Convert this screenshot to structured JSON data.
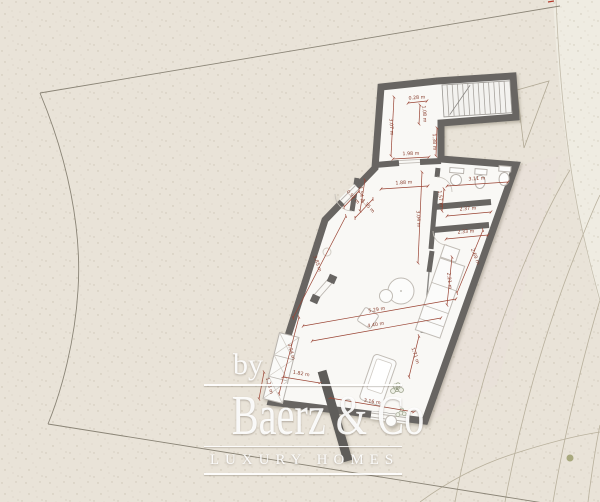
{
  "title": "Villa site / floor plan with dimensions",
  "colors": {
    "background": "#e9e3d8",
    "background_outside": "#efece2",
    "terrace_tint": "#e9dfd9",
    "wall": "#676562",
    "floor": "#f9f8f5",
    "stair_tread": "#f3f2ef",
    "dimension": "#9a4434",
    "boundary_line": "#8a8476",
    "contour_line": "#b8b09c",
    "vegetation_dot": "#a9a97e",
    "logo_text": "#ffffff"
  },
  "watermark": {
    "by": "by",
    "brand": "Baerz & Co",
    "tagline": "LUXURY HOMES"
  },
  "plan": {
    "units": "m",
    "dimensions": [
      {
        "label": "0.28 m",
        "x": 417,
        "y": 99,
        "rot": -4,
        "line": [
          408,
          103,
          427,
          101
        ]
      },
      {
        "label": "1.08 m",
        "x": 423,
        "y": 114,
        "rot": 86,
        "line": [
          420,
          105,
          419,
          124
        ]
      },
      {
        "label": "3.07 m",
        "x": 390,
        "y": 127,
        "rot": 87,
        "line": [
          394,
          97,
          391,
          156
        ]
      },
      {
        "label": "1.98 m",
        "x": 411,
        "y": 155,
        "rot": -2,
        "line": [
          393,
          159,
          429,
          157
        ]
      },
      {
        "label": "1.38 m",
        "x": 433,
        "y": 142,
        "rot": 88,
        "line": [
          437,
          128,
          436,
          156
        ]
      },
      {
        "label": "1.88 m",
        "x": 404,
        "y": 184,
        "rot": -3,
        "line": [
          381,
          189,
          428,
          186
        ]
      },
      {
        "label": "1.54 m",
        "x": 360,
        "y": 195,
        "rot": 82,
        "line": [
          365,
          180,
          360,
          211
        ]
      },
      {
        "label": "3.11 m",
        "x": 477,
        "y": 180,
        "rot": -3,
        "line": [
          447,
          186,
          508,
          182
        ]
      },
      {
        "label": "1.57 m",
        "x": 439,
        "y": 199,
        "rot": 84,
        "line": [
          444,
          189,
          442,
          211
        ]
      },
      {
        "label": "2.37 m",
        "x": 468,
        "y": 210,
        "rot": -4,
        "line": [
          447,
          216,
          491,
          212
        ]
      },
      {
        "label": "2.33 m",
        "x": 466,
        "y": 233,
        "rot": -4,
        "line": [
          446,
          239,
          488,
          235
        ]
      },
      {
        "label": "3.04 m",
        "x": 417,
        "y": 219,
        "rot": 87,
        "line": [
          422,
          172,
          418,
          263
        ]
      },
      {
        "label": "2.21 m",
        "x": 448,
        "y": 281,
        "rot": 84,
        "line": [
          452,
          257,
          447,
          305
        ]
      },
      {
        "label": "2.69 m",
        "x": 474,
        "y": 257,
        "rot": 68,
        "line": [
          483,
          230,
          457,
          293
        ]
      },
      {
        "label": "0.92 m",
        "x": 352,
        "y": 198,
        "rot": 47,
        "line": [
          344,
          207,
          359,
          191
        ]
      },
      {
        "label": "1.35 m",
        "x": 367,
        "y": 207,
        "rot": 47,
        "line": [
          355,
          218,
          373,
          199
        ]
      },
      {
        "label": "3.85 m",
        "x": 316,
        "y": 264,
        "rot": 71,
        "line": [
          346,
          216,
          293,
          318
        ]
      },
      {
        "label": "5.29 m",
        "x": 377,
        "y": 311,
        "rot": -9,
        "line": [
          303,
          326,
          456,
          299
        ]
      },
      {
        "label": "4.40 m",
        "x": 376,
        "y": 326,
        "rot": -9,
        "line": [
          312,
          341,
          441,
          318
        ]
      },
      {
        "label": "3.94 m",
        "x": 290,
        "y": 352,
        "rot": 75,
        "line": [
          299,
          317,
          279,
          394
        ]
      },
      {
        "label": "1.23 m",
        "x": 268,
        "y": 386,
        "rot": 75,
        "line": [
          264,
          372,
          259,
          399
        ]
      },
      {
        "label": "1.82 m",
        "x": 301,
        "y": 375,
        "rot": 10,
        "line": [
          283,
          377,
          320,
          383
        ]
      },
      {
        "label": "1.71 m",
        "x": 414,
        "y": 356,
        "rot": 72,
        "line": [
          419,
          336,
          409,
          377
        ]
      },
      {
        "label": "3.16 m",
        "x": 372,
        "y": 403,
        "rot": 9,
        "line": [
          330,
          398,
          414,
          412
        ]
      }
    ]
  }
}
